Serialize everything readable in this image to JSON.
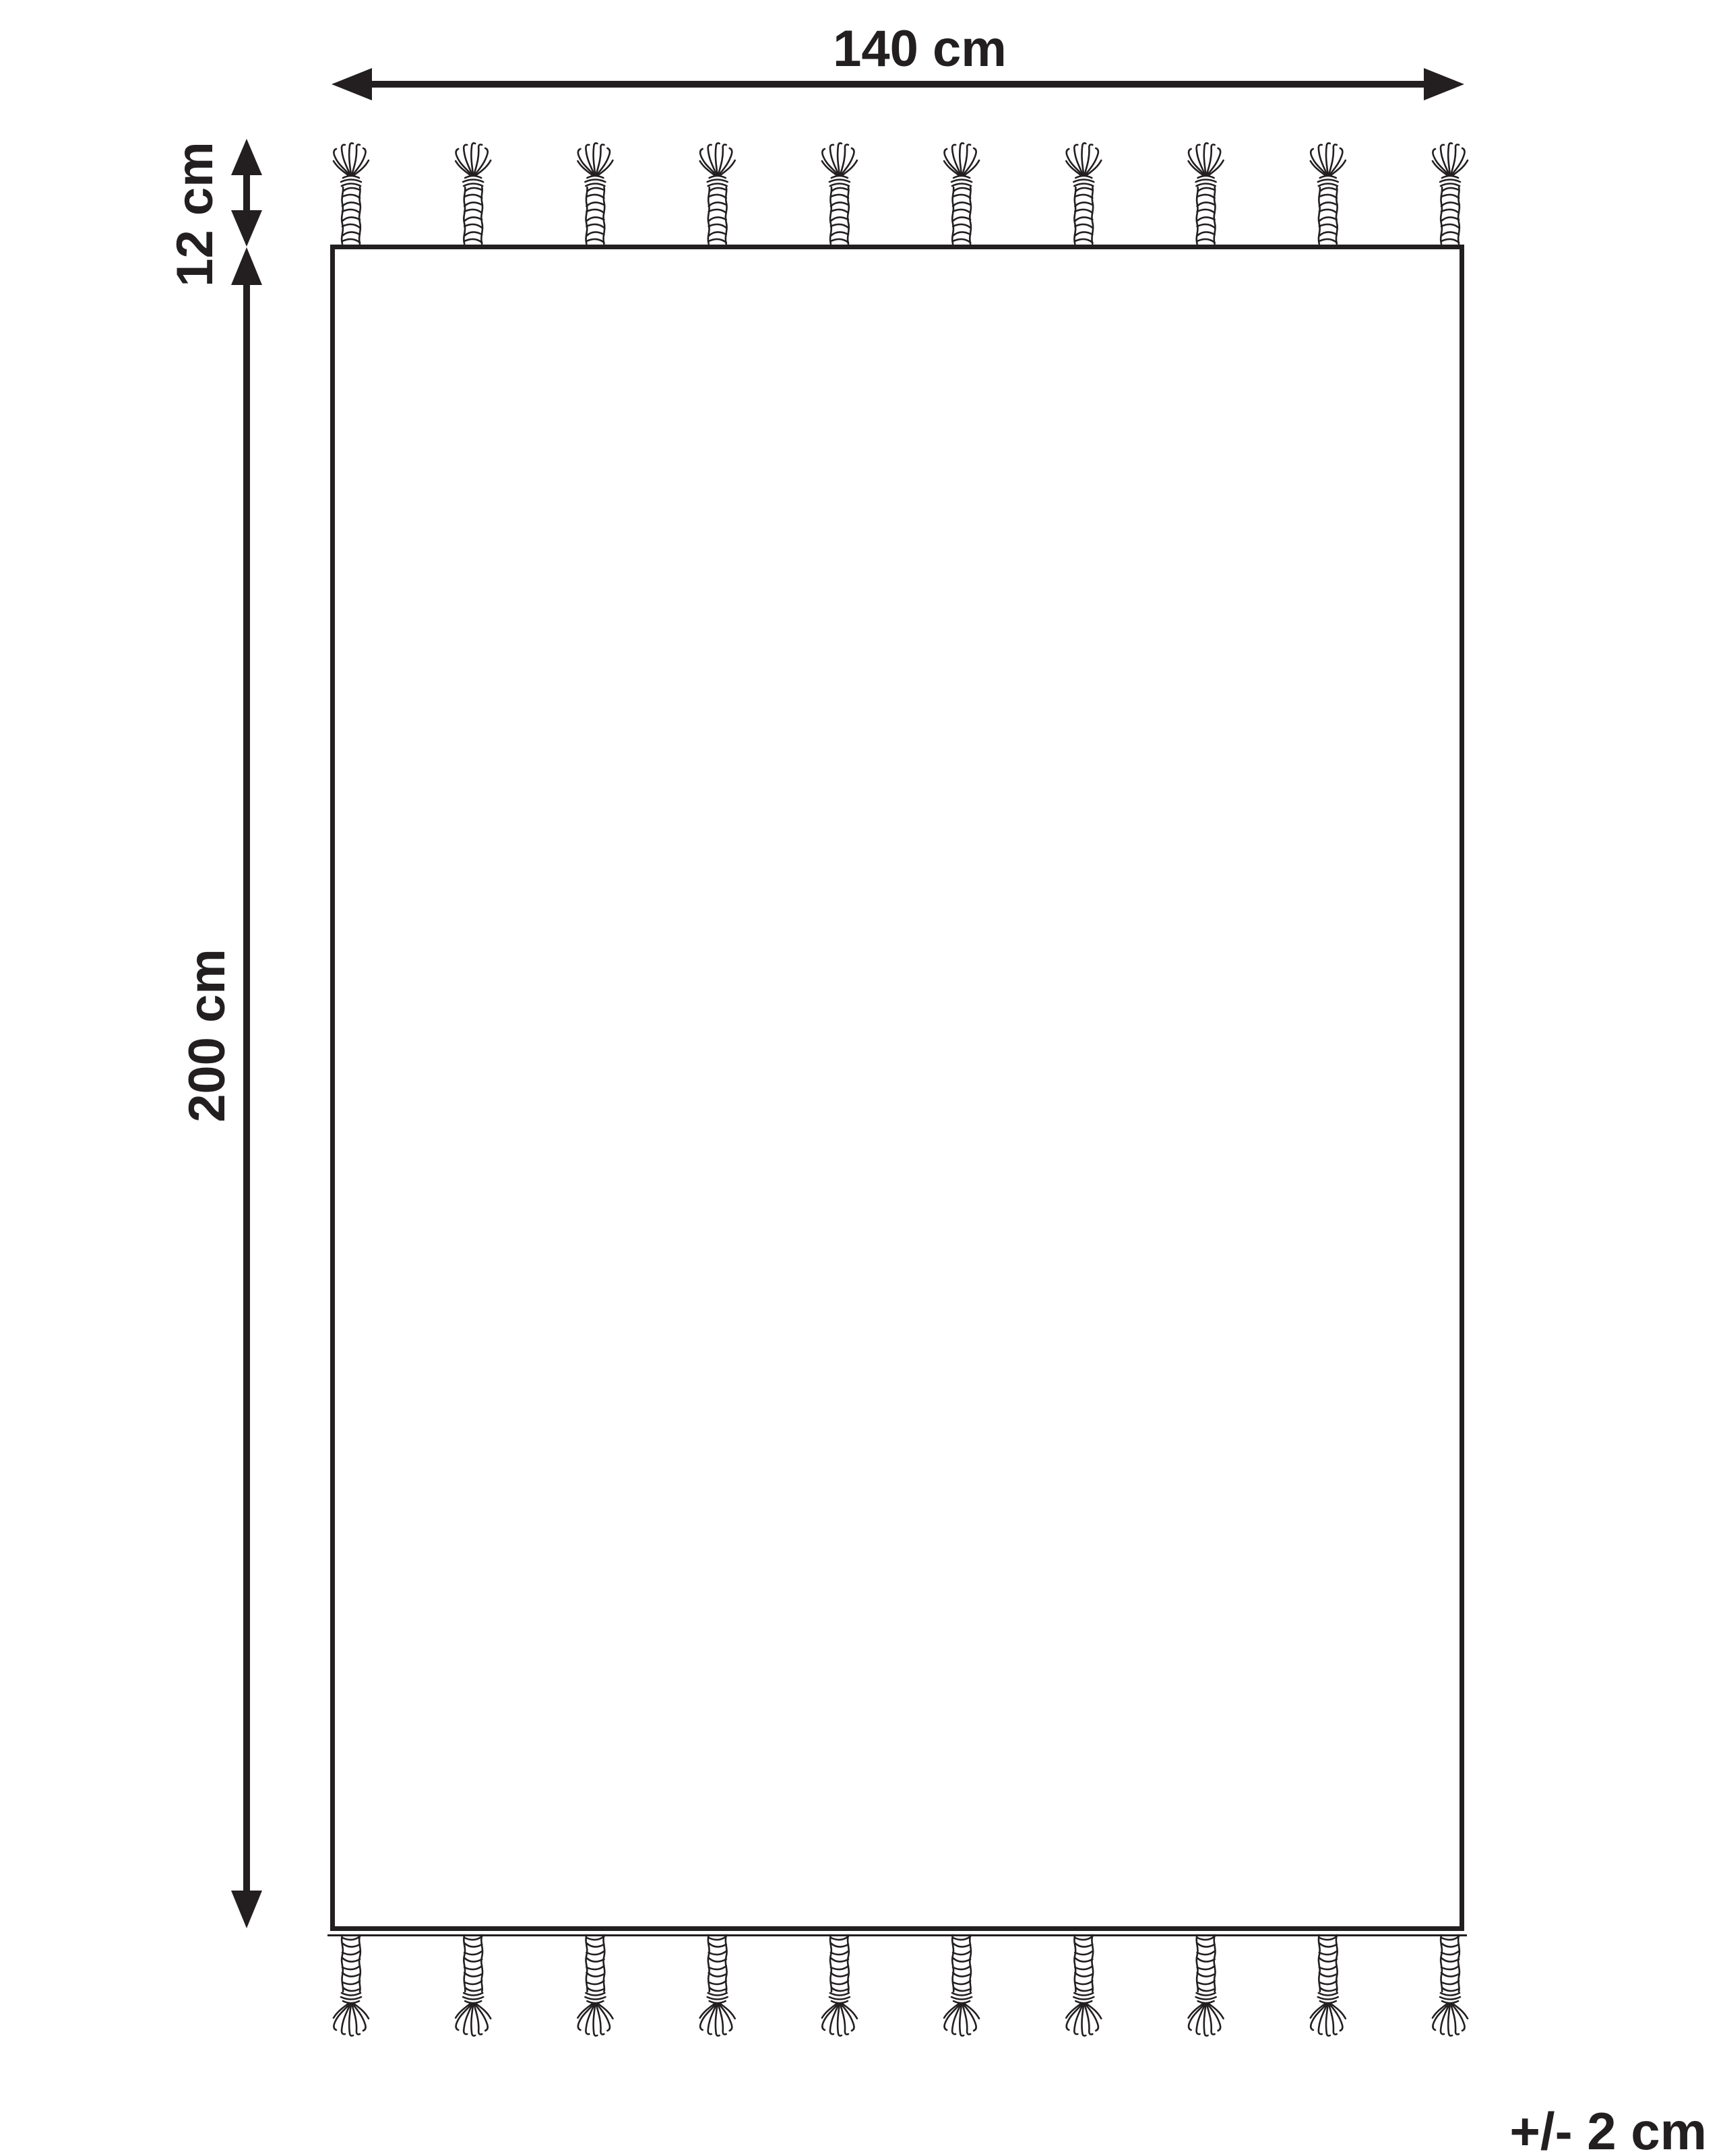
{
  "diagram": {
    "labels": {
      "width": "140 cm",
      "height": "200 cm",
      "fringe": "12 cm",
      "tolerance": "+/- 2 cm"
    },
    "fringe": {
      "top_tassel_count": 10,
      "bottom_tassel_count": 10
    },
    "colors": {
      "ink": "#231f20",
      "background": "#ffffff"
    }
  }
}
